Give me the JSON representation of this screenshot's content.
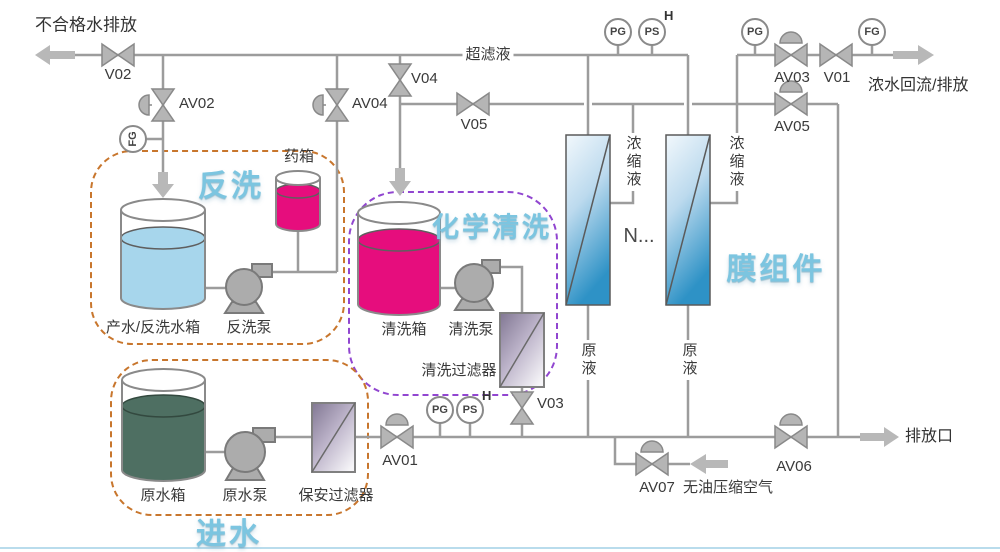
{
  "diagram": {
    "streams": {
      "unqualified_water_discharge": "不合格水排放",
      "ultrafiltrate": "超滤液",
      "concentrate_return_discharge": "浓水回流/排放",
      "concentrate_liquid": "浓缩液",
      "raw_liquid": "原液",
      "discharge_outlet": "排放口",
      "oil_free_compressed_air": "无油压缩空气",
      "more_modules": "N..."
    },
    "valves": {
      "v01": "V01",
      "v02": "V02",
      "v03": "V03",
      "v04": "V04",
      "v05": "V05",
      "av01": "AV01",
      "av02": "AV02",
      "av03": "AV03",
      "av04": "AV04",
      "av05": "AV05",
      "av06": "AV06",
      "av07": "AV07"
    },
    "gauges": {
      "pg": "PG",
      "ps": "PS",
      "fg": "FG",
      "high_alarm": "H"
    },
    "sections": {
      "backwash": {
        "title": "反洗",
        "tank": "产水/反洗水箱",
        "pump": "反洗泵",
        "chemical_tank": "药箱"
      },
      "chemical_clean": {
        "title": "化学清洗",
        "tank": "清洗箱",
        "pump": "清洗泵",
        "filter": "清洗过滤器"
      },
      "feed": {
        "title": "进水",
        "tank": "原水箱",
        "pump": "原水泵",
        "filter": "保安过滤器"
      },
      "membrane": {
        "title": "膜组件"
      }
    },
    "colors": {
      "pipe": "#9c9c9c",
      "section_orange": "#c8762d",
      "section_purple": "#9146d0",
      "magenta_liquid": "#e60d7d",
      "light_blue_liquid": "#a7d6ec",
      "dark_green_liquid": "#4e6f62",
      "title_blue": "#7cc5e0"
    }
  }
}
